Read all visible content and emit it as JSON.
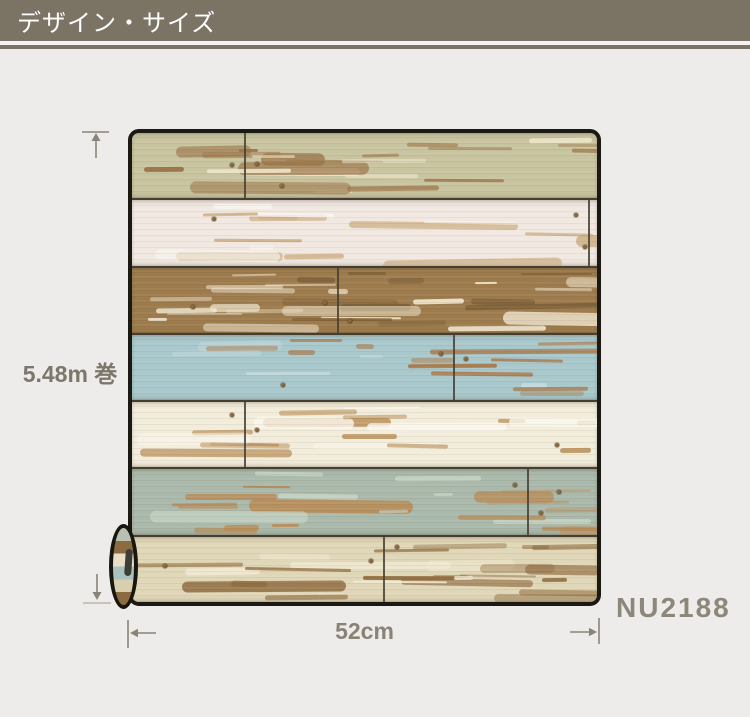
{
  "page": {
    "background": "#edecea"
  },
  "header": {
    "title": "デザイン・サイズ",
    "background": "#7b7465",
    "text_color": "#ffffff",
    "underline_light": "#f4f3f0"
  },
  "annotations": {
    "arrow_color": "#8a8377",
    "roll_length": {
      "label": "5.48m 巻",
      "color": "#7d776b"
    },
    "roll_width": {
      "label": "52cm",
      "color": "#8a8275"
    },
    "product_code": {
      "label": "NU2188",
      "color": "#8d8779"
    }
  },
  "wallpaper": {
    "border_color": "#1a1913",
    "seam_color": "#453f33",
    "planks": [
      {
        "name": "sage-green",
        "base": "#c8c49f",
        "accent": "#9a7347",
        "highlight": "#ece5c8",
        "seam_x_pct": 24,
        "density": 22
      },
      {
        "name": "antique-white",
        "base": "#f0e8e1",
        "accent": "#c9a97c",
        "highlight": "#faf6f1",
        "seam_x_pct": 98,
        "density": 15
      },
      {
        "name": "worn-brown",
        "base": "#9d7b4c",
        "accent": "#f0e6cf",
        "highlight": "#7e6038",
        "seam_x_pct": 44,
        "density": 30
      },
      {
        "name": "sky-blue",
        "base": "#a9c8cc",
        "accent": "#a8794a",
        "highlight": "#c6dadd",
        "seam_x_pct": 69,
        "density": 17
      },
      {
        "name": "cream-white",
        "base": "#f2ecdb",
        "accent": "#b98f59",
        "highlight": "#fbf8ee",
        "seam_x_pct": 24,
        "density": 18
      },
      {
        "name": "pale-sage",
        "base": "#a9b9ab",
        "accent": "#b98a55",
        "highlight": "#cdd9cb",
        "seam_x_pct": 85,
        "density": 22
      },
      {
        "name": "weathered-tan",
        "base": "#e0d7b8",
        "accent": "#8f6c3f",
        "highlight": "#f0e9d2",
        "seam_x_pct": 54,
        "density": 27
      }
    ]
  },
  "roll": {
    "outline": "#17160f",
    "core_color": "#3e3d37",
    "bands": [
      "#b9c0b0",
      "#8d6b40",
      "#e8dfc6",
      "#a9c2c0",
      "#d9cfae",
      "#8d6b40"
    ]
  }
}
